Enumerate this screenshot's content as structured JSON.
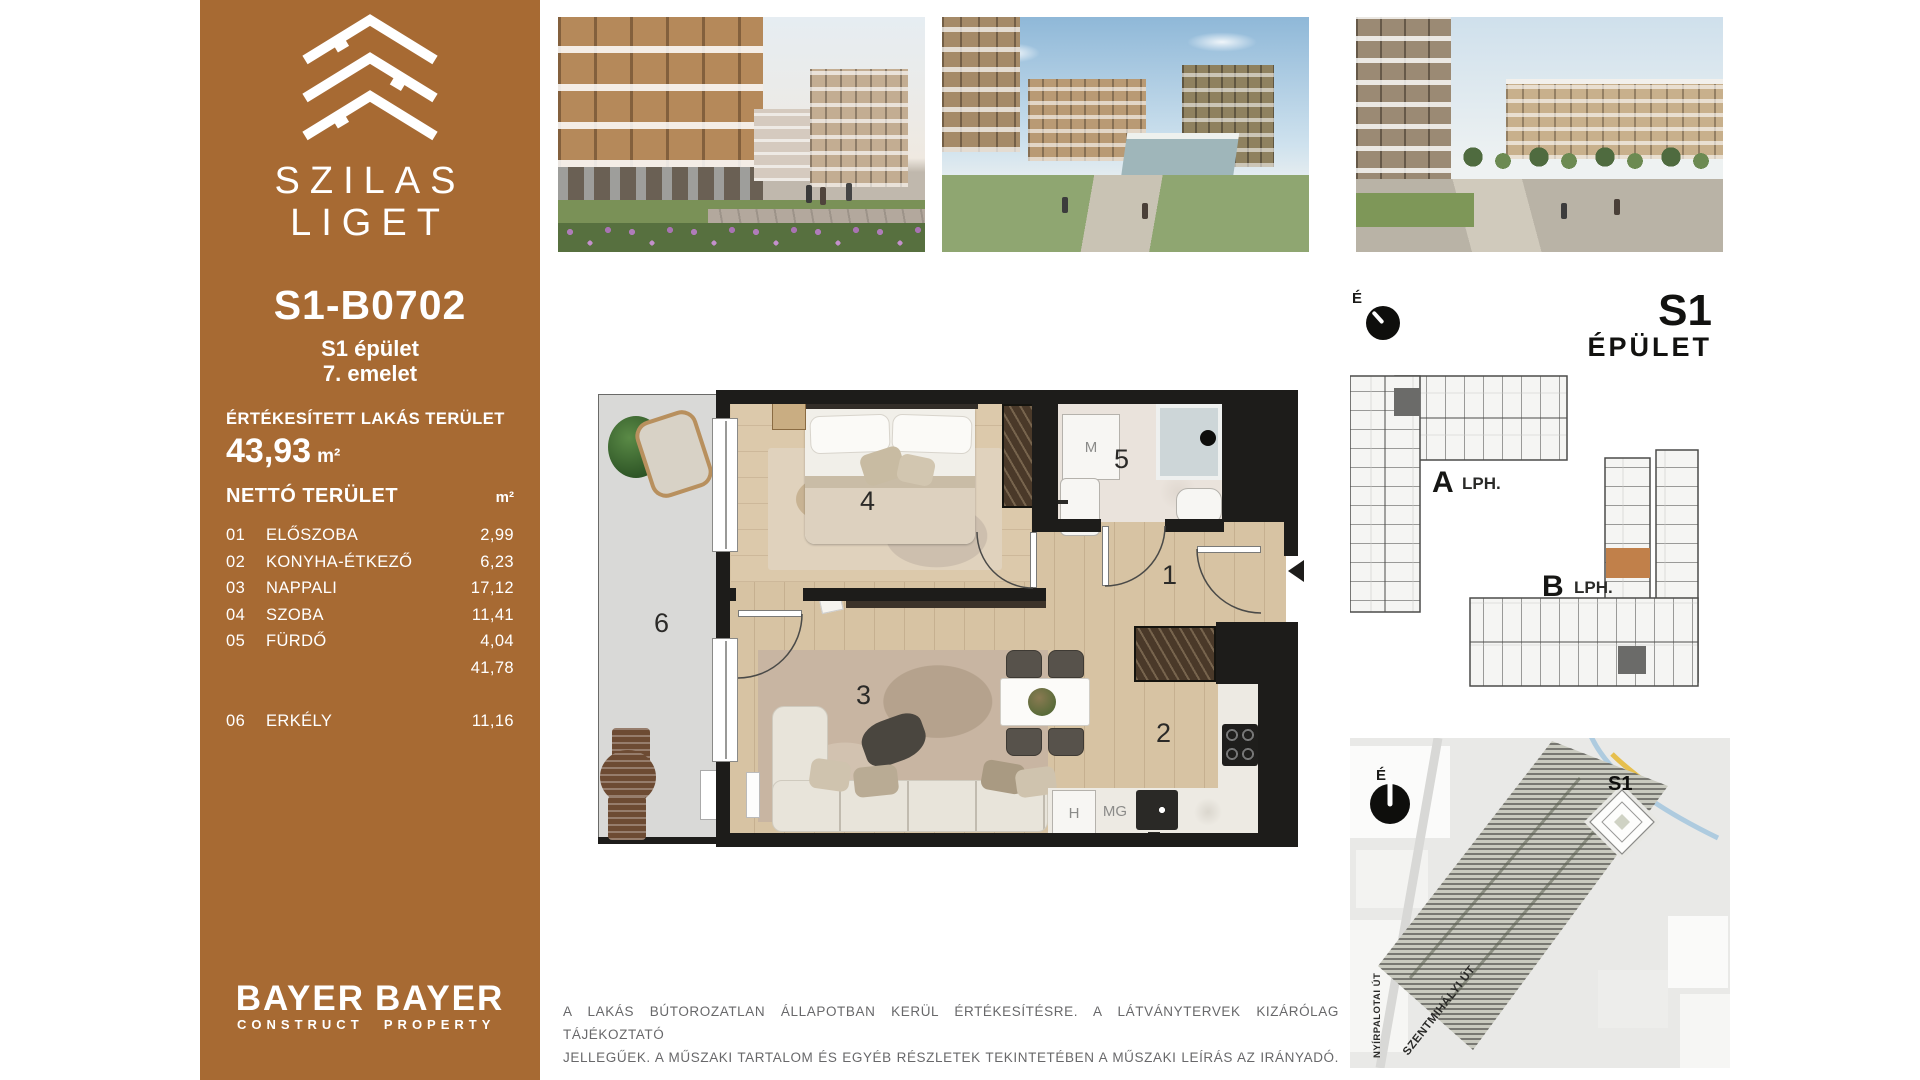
{
  "sidebar": {
    "brand_top": "SZILAS",
    "brand_bottom": "LIGET",
    "unit_code": "S1-B0702",
    "building": "S1 épület",
    "floor": "7. emelet",
    "sold_label": "ÉRTÉKESÍTETT LAKÁS TERÜLET",
    "sold_value": "43,93",
    "sold_unit": "m²",
    "net_label": "NETTÓ TERÜLET",
    "net_unit": "m²",
    "rooms": [
      {
        "num": "01",
        "name": "ELŐSZOBA",
        "area": "2,99"
      },
      {
        "num": "02",
        "name": "KONYHA-ÉTKEZŐ",
        "area": "6,23"
      },
      {
        "num": "03",
        "name": "NAPPALI",
        "area": "17,12"
      },
      {
        "num": "04",
        "name": "SZOBA",
        "area": "11,41"
      },
      {
        "num": "05",
        "name": "FÜRDŐ",
        "area": "4,04"
      }
    ],
    "net_total": "41,78",
    "balcony": {
      "num": "06",
      "name": "ERKÉLY",
      "area": "11,16"
    },
    "logos": [
      {
        "name": "BAYER",
        "sub": "CONSTRUCT"
      },
      {
        "name": "BAYER",
        "sub": "PROPERTY"
      }
    ]
  },
  "floorplan": {
    "numbers": {
      "hall": "1",
      "kitchen": "2",
      "living": "3",
      "bedroom": "4",
      "bath": "5",
      "balcony": "6"
    },
    "appliances": {
      "washing_machine": "M",
      "fridge": "H",
      "dishwasher": "MG"
    }
  },
  "right_panel": {
    "compass": "É",
    "title": "S1",
    "subtitle": "ÉPÜLET",
    "stairA": {
      "letter": "A",
      "suffix": "LPH."
    },
    "stairB": {
      "letter": "B",
      "suffix": "LPH."
    }
  },
  "sitemap": {
    "compass": "É",
    "building_label": "S1",
    "street_vertical": "NYÍRPALOTAI ÚT",
    "street_diagonal": "SZENTMIHÁLYI ÚT"
  },
  "disclaimer": {
    "line1": "A LAKÁS BÚTOROZATLAN ÁLLAPOTBAN KERÜL ÉRTÉKESÍTÉSRE. A LÁTVÁNYTERVEK KIZÁRÓLAG TÁJÉKOZTATÓ",
    "line2": "JELLEGŰEK. A MŰSZAKI TARTALOM ÉS EGYÉB RÉSZLETEK TEKINTETÉBEN A MŰSZAKI LEÍRÁS AZ IRÁNYADÓ."
  },
  "colors": {
    "sidebar_brown": "#a76a33",
    "wall_black": "#1d1c1a",
    "unit_highlight": "#c1804a",
    "wood_floor": "#d7c3a3"
  }
}
